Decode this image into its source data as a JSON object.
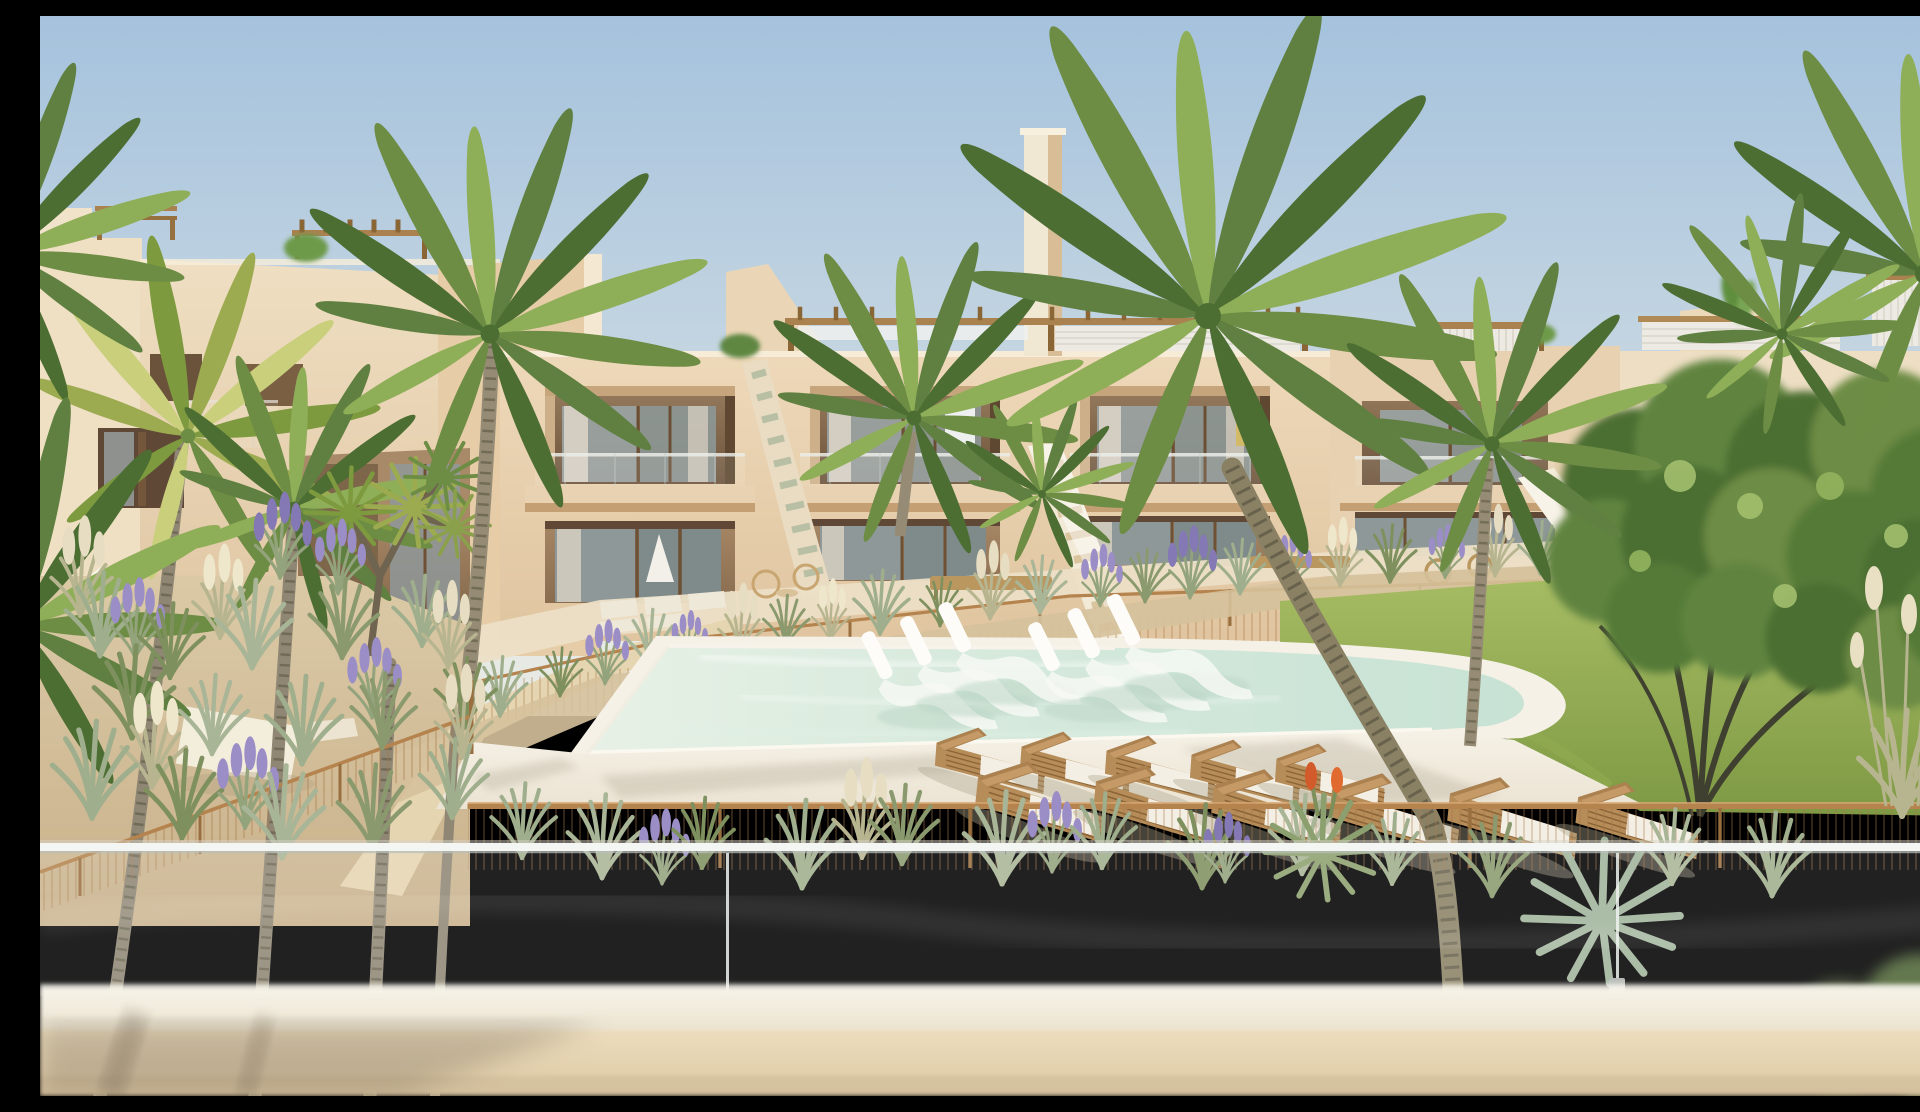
{
  "meta": {
    "description": "Photorealistic architectural rendering of a modern beige two-storey apartment complex with communal pool, in-pool white loungers, rows of wooden sun loungers, palm trees, a leafy tree, lawn, desert-style gravel landscaping with grasses and lavender, bronze wire pool fencing, rooftop pergolas and exterior staircases, viewed from a balcony behind a frameless glass balustrade",
    "image_type": "architectural-render",
    "visible_text": "none"
  },
  "palette": {
    "sky_top": "#a5c2dd",
    "sky_mid": "#c2d4e1",
    "sky_low": "#dbe4e4",
    "sky_horizon": "#e7eae4",
    "facade_light": "#eed9ba",
    "facade_mid": "#e0c5a0",
    "facade_shadow": "#c49f74",
    "recess_dark": "#6b523a",
    "window_glass": "#9aa4a4",
    "curtain": "#dad3c6",
    "pergola_wood": "#a9824f",
    "louver_white": "#eceae2",
    "pool_light": "#e8f1e6",
    "pool_mid": "#d5e9dc",
    "pool_deep": "#c7e2d4",
    "deck_light": "#f8f4ea",
    "deck_dark": "#eae2d1",
    "lawn_light": "#aabf66",
    "lawn_dark": "#7e9944",
    "gravel": "#dccaa7",
    "fence_bronze": "#b5834e",
    "lounger_wood": "#b68c58",
    "cushion_white": "#f4efe4",
    "inpool_lounger": "#fdfcf8",
    "palm_dark": "#4c6e33",
    "palm_mid": "#6d8c44",
    "palm_light": "#8fae58",
    "trunk": "#8d8168",
    "sage": "#9fae8c",
    "lavender": "#9b8ec6",
    "plume": "#e6ddc2",
    "glass_edge": "#f4f6f3",
    "wall_light": "#eddebf",
    "wall_dark": "#dcc8a2"
  },
  "scene": {
    "elements": [
      "sky",
      "apartment-buildings",
      "rooftop-pergolas",
      "balconies",
      "exterior-stairs",
      "swimming-pool",
      "in-pool-loungers",
      "sun-loungers",
      "pool-deck",
      "lawn",
      "leafy-tree",
      "palm-trees",
      "gravel-garden",
      "grass-plants",
      "lavender-plants",
      "bronze-fence",
      "foreground-glass-balustrade",
      "foreground-wall"
    ]
  }
}
